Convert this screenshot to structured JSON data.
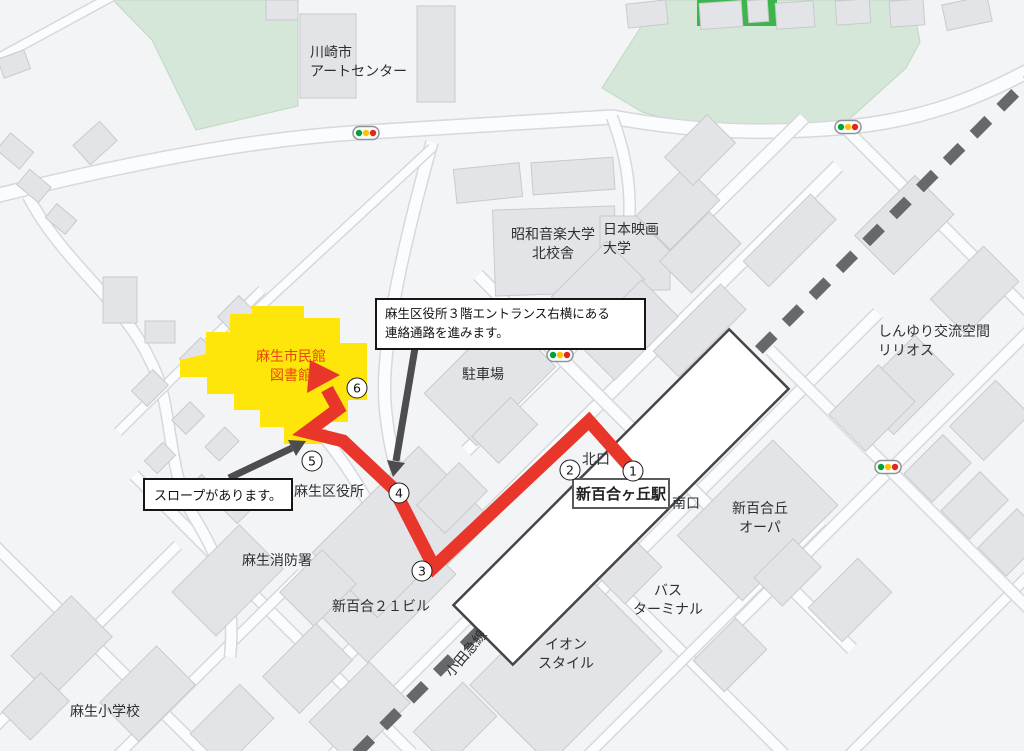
{
  "colors": {
    "route_red": "#e8362b",
    "library_yellow": "#ffe60a",
    "park_green": "#d5e7d8",
    "bright_green": "#3cb54a",
    "building_gray": "#e3e4e7",
    "railway_gray": "#67686b",
    "label_red": "#e8490c"
  },
  "labels": {
    "art_center": "川崎市\nアートセンター",
    "showa_music": "昭和音楽大学\n北校舎",
    "film_univ": "日本映画\n大学",
    "lirios": "しんゆり交流空間\nリリオス",
    "parking": "駐車場",
    "library": "麻生市民館\n図書館",
    "ward_office": "麻生区役所",
    "fire_station": "麻生消防署",
    "shinyuri21": "新百合２１ビル",
    "north_exit": "北口",
    "south_exit": "南口",
    "station": "新百合ヶ丘駅",
    "opa": "新百合丘\nオーパ",
    "bus_terminal": "バス\nターミナル",
    "aeon": "イオン\nスタイル",
    "elementary": "麻生小学校",
    "odakyu": "小田急線"
  },
  "callouts": {
    "corridor": "麻生区役所３階エントランス右横にある\n連絡通路を進みます。",
    "slope": "スロープがあります。"
  },
  "route_markers": {
    "m1": "1",
    "m2": "2",
    "m3": "3",
    "m4": "4",
    "m5": "5",
    "m6": "6"
  }
}
